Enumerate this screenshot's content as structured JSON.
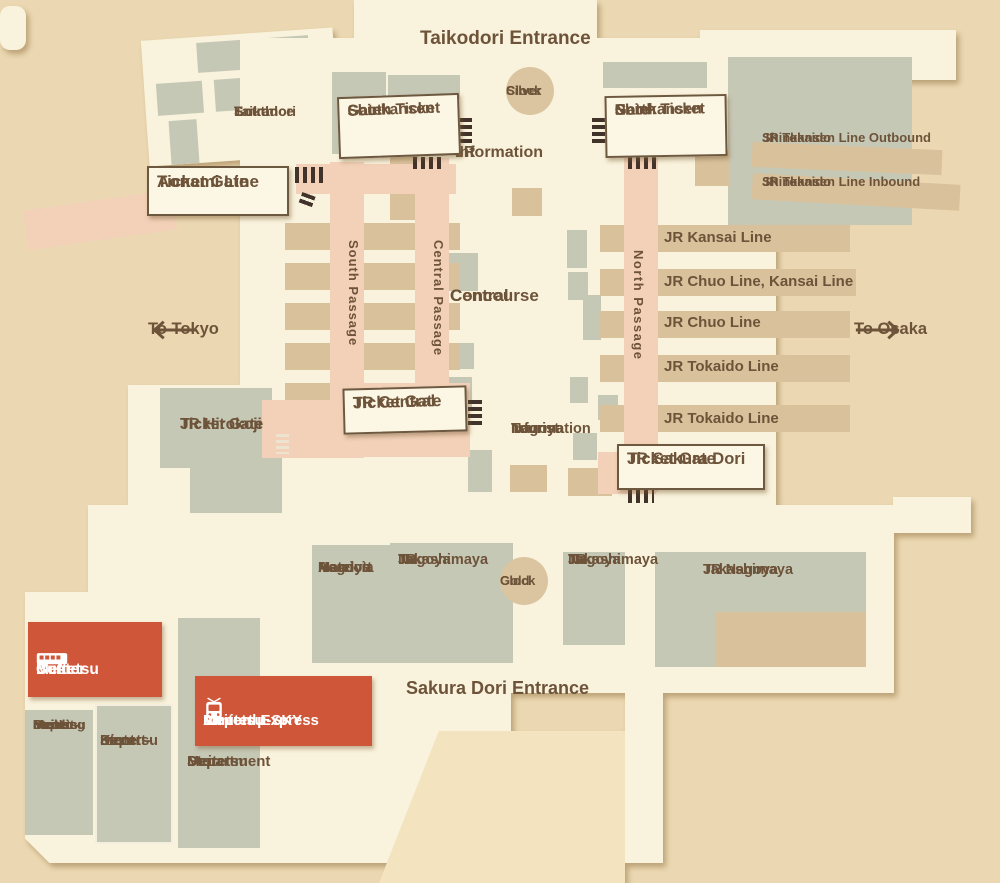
{
  "colors": {
    "background": "#ebd8b2",
    "floor": "#f9f2dc",
    "plaza": "#f3e3bf",
    "building_block": "#c6c8b6",
    "platform_tan": "#d8c19b",
    "passage_pink": "#f2d1b8",
    "highlight_red": "#d0563a",
    "label_brown": "#6d5339"
  },
  "labels": {
    "taikodori_entrance": "Taikodori Entrance",
    "taikodori_south_entrance": [
      "Taikodori",
      "South",
      "Entrance"
    ],
    "silver_clock": [
      "Silver",
      "Clock"
    ],
    "gold_clock": [
      "Gold",
      "Clock"
    ],
    "jr_information": [
      "JR",
      "Information"
    ],
    "central_concourse": [
      "Central",
      "Concourse"
    ],
    "nagoya_tourist_information": [
      "Nagoya",
      "Tourist",
      "Information"
    ],
    "sakura_dori_entrance": "Sakura Dori Entrance",
    "to_tokyo": "To Tokyo",
    "to_osaka": "To Osaka"
  },
  "gates": {
    "shinkansen_south": [
      "Shinkansen",
      "South Ticket",
      "Gate"
    ],
    "shinkansen_north": [
      "Shinkansen",
      "North Ticket",
      "Gate"
    ],
    "aonami": [
      "Aonami Line",
      "Ticket Gate"
    ],
    "jr_central": [
      "JR Central",
      "Ticket Gate"
    ],
    "jr_sakura_dori": [
      "JR Sakura Dori",
      "Ticket Gate"
    ],
    "jr_hirokoji": [
      "JR Hirokoji",
      "Ticket Gate"
    ]
  },
  "passages": {
    "south": "South Passage",
    "central": "Central Passage",
    "north": "North Passage"
  },
  "platforms": {
    "shinkansen_outbound": [
      "JR Tokaido",
      "Shinkansen Line Outbound"
    ],
    "shinkansen_inbound": [
      "JR Tokaido",
      "Shinkansen Line Inbound"
    ],
    "kansai": "JR Kansai Line",
    "chuo_kansai": "JR Chuo Line, Kansai Line",
    "chuo": "JR Chuo Line",
    "tokaido_upper": "JR Tokaido Line",
    "tokaido_lower": "JR Tokaido Line"
  },
  "buildings": {
    "marriott": [
      "Nagoya",
      "Marriott",
      "Associa",
      "Hotel"
    ],
    "takashimaya_west": [
      "JR",
      "Nagoya",
      "Takashimaya"
    ],
    "takashimaya_center": [
      "JR",
      "Nagoya",
      "Takashimaya"
    ],
    "takashimaya_east": [
      "JR Nagoya",
      "Takashimaya"
    ],
    "meitetsu_mens": [
      "Meitetsu",
      "Depart-",
      "ment",
      "Store",
      "Men's",
      "Building"
    ],
    "kintetsu": [
      "Kintetsu",
      "Depart-",
      "ment",
      "Store"
    ],
    "meitetsu_dept": [
      "Meitetsu",
      "Department",
      "Store"
    ]
  },
  "transit": {
    "bus_center": [
      "Meitetsu",
      "Bus",
      "Center"
    ],
    "airport_express": [
      "Meitetsu",
      "Airport μ-SKY",
      "Limited Express"
    ]
  }
}
